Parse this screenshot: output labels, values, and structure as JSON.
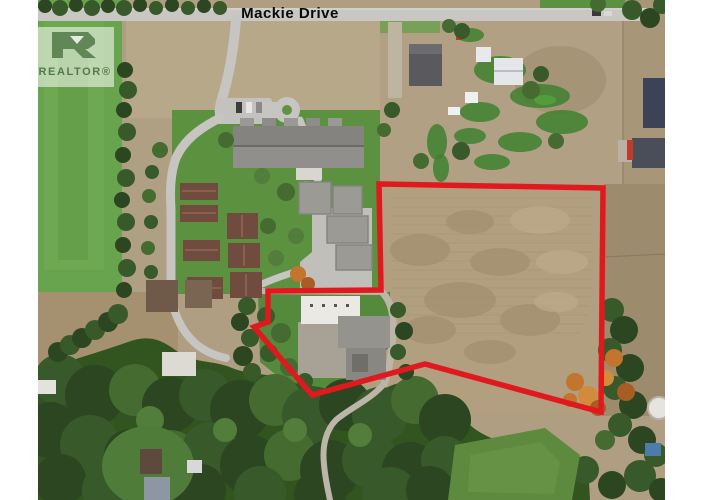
{
  "photo": {
    "street_label": "Mackie Drive"
  },
  "watermark": {
    "brand": "REALTOR®"
  },
  "boundary": {
    "color": "#e0191f",
    "stroke_width": "5.5",
    "points": "379,184 603,188 601,412 425,364 312,395 254,327 268,322 268,291 381,290"
  },
  "colors": {
    "boundary_red": "#e0191f",
    "field_green": "#68a34d",
    "dirt_tan": "#b2a184",
    "forest_green": "#2e4a24",
    "road_gray": "#c7c6c2",
    "label_black": "#0a0a0a",
    "frame_white": "#ffffff"
  }
}
